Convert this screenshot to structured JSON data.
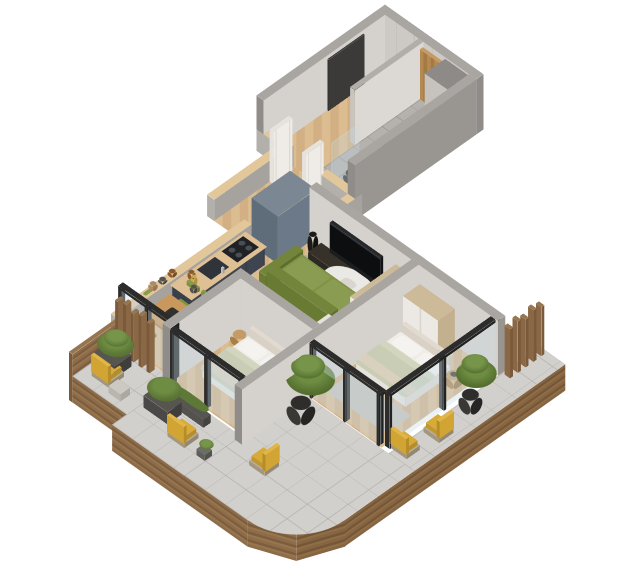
{
  "scene": {
    "description": "3D isometric cutaway render of an apartment floor plan on a white background",
    "projection": "isometric",
    "background_color": "#ffffff"
  },
  "rooms": [
    {
      "id": "entry-hall",
      "label": "Entry Hall",
      "floor": "herringbone oak",
      "contents": [
        "entry-door"
      ]
    },
    {
      "id": "bathroom",
      "label": "Bathroom",
      "floor": "gray ceramic tile",
      "contents": [
        "washing-machine",
        "wall-hung-toilet",
        "walk-in-shower",
        "shower-column",
        "wood-accent-wall",
        "wall-shelves",
        "tiled-ledge",
        "dark-vase",
        "exhaust-duct",
        "white-doors"
      ]
    },
    {
      "id": "corridor",
      "label": "Corridor",
      "floor": "herringbone oak",
      "contents": [
        "cut-wall-stubs-with-wood-caps"
      ]
    },
    {
      "id": "kitchen",
      "label": "Kitchen",
      "floor": "herringbone oak",
      "contents": [
        "charcoal-base-cabinets",
        "wood-countertop",
        "cooktop",
        "sink",
        "faucet",
        "tall-blue-gray-cabinet",
        "jars-and-bottles"
      ]
    },
    {
      "id": "dining-area",
      "label": "Dining Area",
      "floor": "herringbone oak",
      "contents": [
        "wood-dining-table",
        "green-chairs-x4",
        "serving-tray"
      ]
    },
    {
      "id": "living-room",
      "label": "Living Room",
      "floor": "herringbone oak",
      "contents": [
        "green-sofa",
        "gray-rug",
        "white-oval-coffee-table",
        "tv",
        "tv-console",
        "speakers",
        "wardrobe",
        "white-door"
      ]
    },
    {
      "id": "bedroom-1",
      "label": "Bedroom 1",
      "floor": "herringbone oak",
      "contents": [
        "double-bed-sage-bedding",
        "nightstand",
        "glass-sliding-wall"
      ]
    },
    {
      "id": "bedroom-2",
      "label": "Bedroom 2",
      "floor": "herringbone oak",
      "contents": [
        "double-bed-sage-bedding",
        "wardrobe",
        "round-side-table",
        "rug",
        "glass-sliding-walls"
      ]
    },
    {
      "id": "terrace",
      "label": "Wraparound Balcony Terrace",
      "floor": "light gray tile",
      "contents": [
        "curved-wood-fascia",
        "wood-slat-screen-west",
        "wood-slat-screen-east",
        "yellow-armchairs-x5",
        "planter-boxes",
        "shrubs",
        "potted-trees",
        "side-table"
      ]
    }
  ],
  "palette": {
    "background": "#ffffff",
    "wall_top": "#a9a6a2",
    "wall_interior": "#d5d1cc",
    "wall_exterior": "#999591",
    "cut_wall_cap_wood": "#e2c79b",
    "wood_floor": "#d7b78c",
    "bath_tile": "#b5b1ad",
    "terrace_tile": "#d2d0cd",
    "fascia_wood": "#8d6c49",
    "slat_wood": "#8a6845",
    "kitchen_cabinet": "#3f4550",
    "tall_cabinet": "#6b7988",
    "counter_wood": "#dec094",
    "sofa_green": "#7f9246",
    "chair_green": "#7d9340",
    "dining_wood": "#c9985c",
    "bed_duvet_sage": "#c9cdb5",
    "pillow_white": "#f5f3ef",
    "wardrobe_tan": "#c3b08f",
    "wardrobe_white": "#ece9e4",
    "tv_black": "#0d0e10",
    "armchair_yellow": "#d8ab39",
    "wicker_frame": "#b5a98f",
    "shrub_green": "#5d7837",
    "planter_gray": "#4a4947",
    "glass": "rgba(202,222,232,0.38)",
    "door_white": "#efece8",
    "entry_door_dark": "#3b3a38"
  }
}
